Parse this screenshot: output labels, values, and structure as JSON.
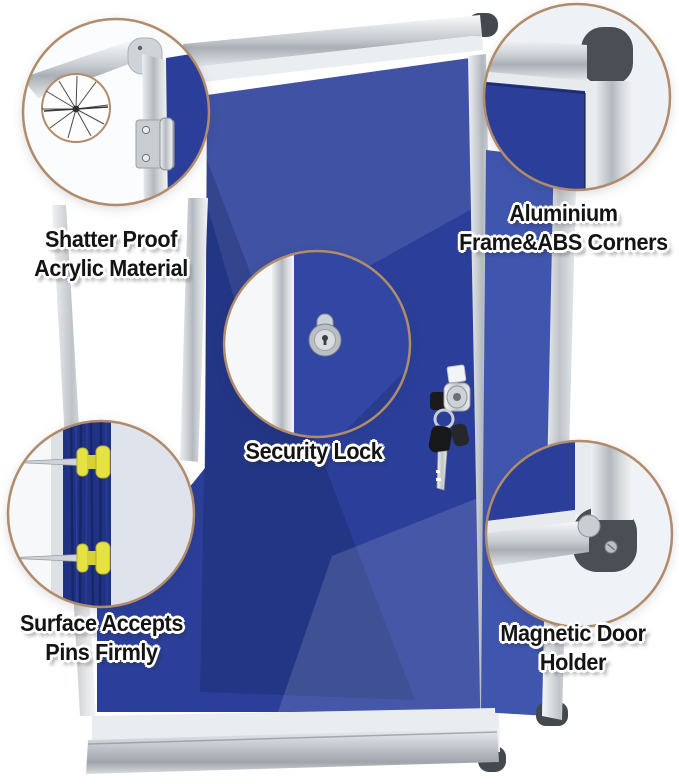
{
  "image": {
    "width": 679,
    "height": 784,
    "background": "#ffffff"
  },
  "product": {
    "kind": "lockable-felt-notice-board",
    "felt_color": "#2b3f9a",
    "felt_highlight_color": "#4056ae",
    "frame_silver_color": "#d9dde1",
    "abs_corner_color": "#44494f",
    "callout_ring_color": "#b08b6c",
    "pin_color": "#e6e243",
    "key_color": "#17181a"
  },
  "icons": {
    "crack": "cracked-acrylic-icon",
    "hinge": "hinge-icon",
    "corner_cap": "abs-corner-cap-icon",
    "lock": "lock-cylinder-icon",
    "keys": "keys-and-lock-icon",
    "pins": "pushpin-icon",
    "magnet": "magnet-icon"
  },
  "callouts": [
    {
      "id": "shatter-proof",
      "feature": "cracked-acrylic-closeup",
      "lines": [
        "Shatter Proof",
        "Acrylic Material"
      ]
    },
    {
      "id": "aluminium-corner",
      "feature": "frame-corner-closeup",
      "lines": [
        "Aluminium",
        "Frame&ABS Corners"
      ]
    },
    {
      "id": "security-lock",
      "feature": "lock-cylinder-closeup",
      "lines": [
        "Security Lock"
      ]
    },
    {
      "id": "pin-surface",
      "feature": "push-pins-closeup",
      "lines": [
        "Surface Accepts",
        "Pins Firmly"
      ]
    },
    {
      "id": "magnetic-holder",
      "feature": "magnet-corner-closeup",
      "lines": [
        "Magnetic Door",
        "Holder"
      ]
    }
  ]
}
